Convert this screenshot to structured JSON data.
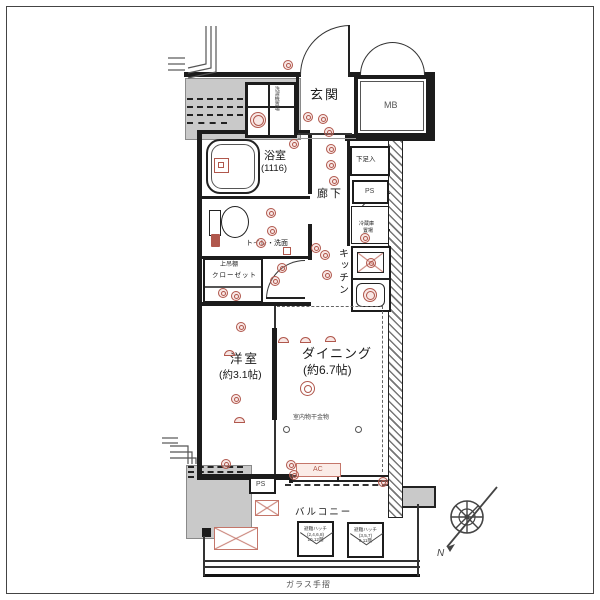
{
  "labels": {
    "genkan": "玄関",
    "mb": "MB",
    "bath": "浴室",
    "bath_size": "(1116)",
    "washer": "洗濯機置場",
    "shoes": "下足入",
    "ps": "PS",
    "hall": "廊下",
    "fridge1": "冷蔵庫",
    "fridge2": "置場",
    "kitchen": "キッチン",
    "toilet": "トイレ・洗面",
    "shelf": "上吊棚",
    "closet": "クローゼット",
    "western": "洋室",
    "western_size": "(約3.1帖)",
    "dining": "ダイニング",
    "dining_size": "(約6.7帖)",
    "hooks": "室内物干金物",
    "ac": "AC",
    "ps2": "PS",
    "balcony": "バルコニー",
    "rail": "ガラス手摺"
  },
  "hatches": {
    "left": {
      "t": "避難ハッチ",
      "f": "(2,4,6,8)",
      "s": "10,12階"
    },
    "right": {
      "t": "避難ハッチ",
      "f": "(3,5,7)",
      "s": "9,11階"
    }
  },
  "compass": {
    "north": "N"
  },
  "colors": {
    "wall": "#1c1c1c",
    "concrete": "#c9c9c9",
    "symbol": "#b0574c"
  }
}
